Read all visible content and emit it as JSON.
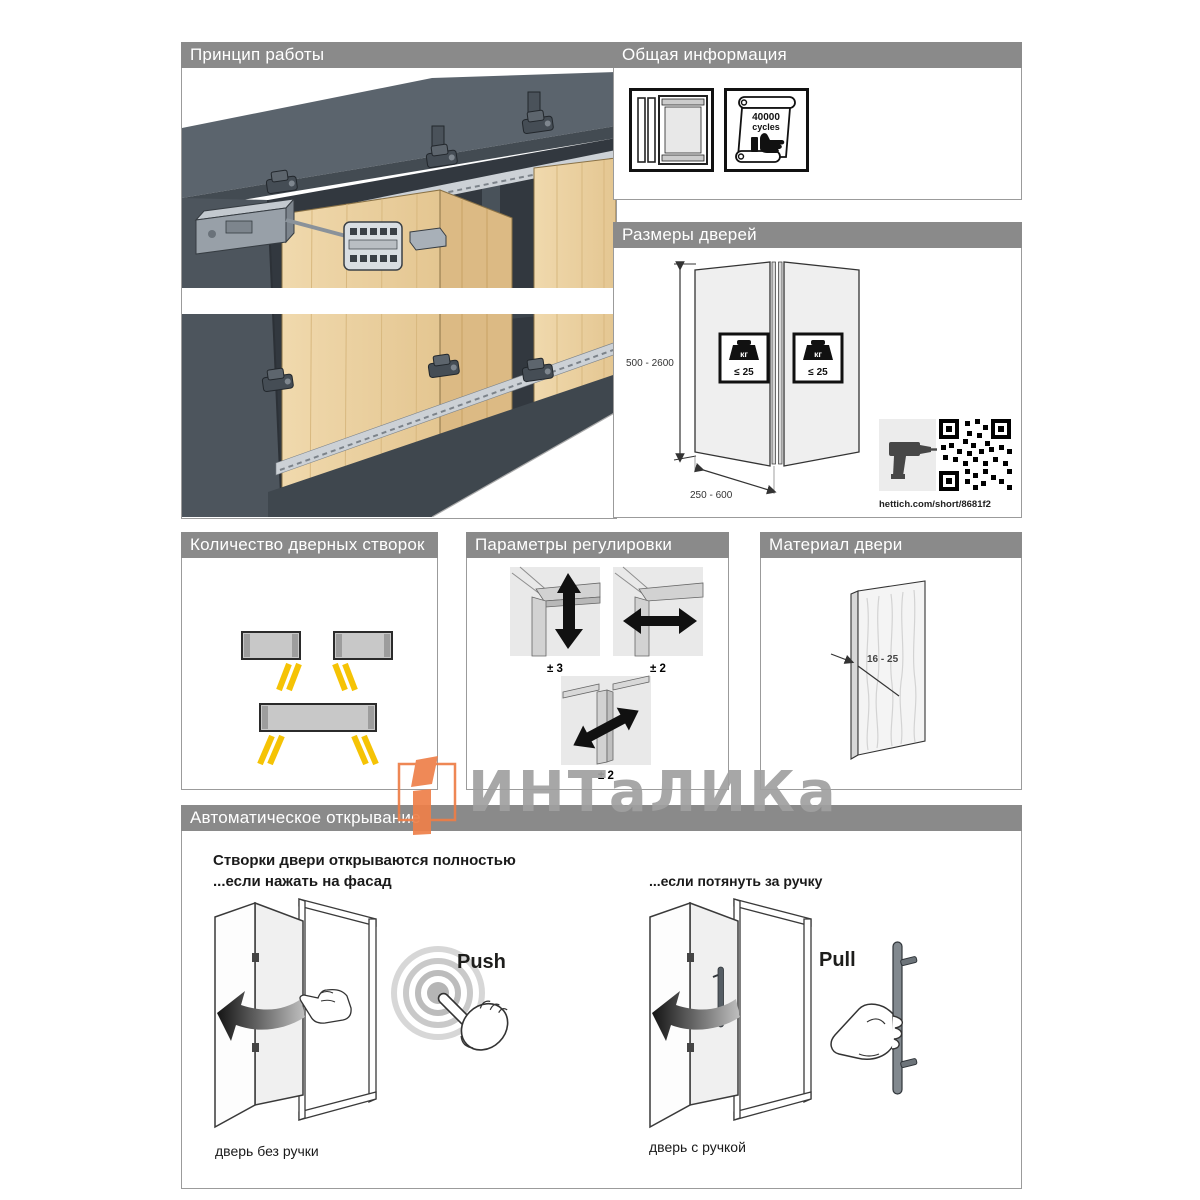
{
  "colors": {
    "header_bar": "#8a8a8a",
    "panel_border": "#9b9b9b",
    "accent_yellow": "#f5c305",
    "wood": "#e9cf9f",
    "carcass_dark": "#4a525a",
    "watermark_orange": "#ee8049",
    "watermark_gray": "#a0a0a0"
  },
  "watermark": {
    "brand": "ИНТаЛИКа"
  },
  "principle": {
    "title": "Принцип работы"
  },
  "general": {
    "title": "Общая информация",
    "cycles_value": "40000",
    "cycles_unit": "cycles"
  },
  "dimensions": {
    "title": "Размеры дверей",
    "height_range": "500 - 2600",
    "width_range": "250 - 600",
    "weight_unit": "кг",
    "weight_limit": "≤ 25",
    "link": "hettich.com/short/8681f2"
  },
  "leaves": {
    "title": "Количество дверных створок"
  },
  "adjustment": {
    "title": "Параметры регулировки",
    "labels": {
      "vertical": "± 3",
      "horizontal": "± 2",
      "tilt": "± 2"
    }
  },
  "material": {
    "title": "Материал двери",
    "thickness_range": "16 - 25"
  },
  "opening": {
    "title": "Автоматическое открывание",
    "headline_line1": "Створки двери открываются полностью",
    "headline_line2": "...если нажать на фасад",
    "pull_note": "...если потянуть за ручку",
    "push_label": "Push",
    "pull_label": "Pull",
    "push_caption": "дверь без ручки",
    "pull_caption": "дверь с ручкой"
  }
}
